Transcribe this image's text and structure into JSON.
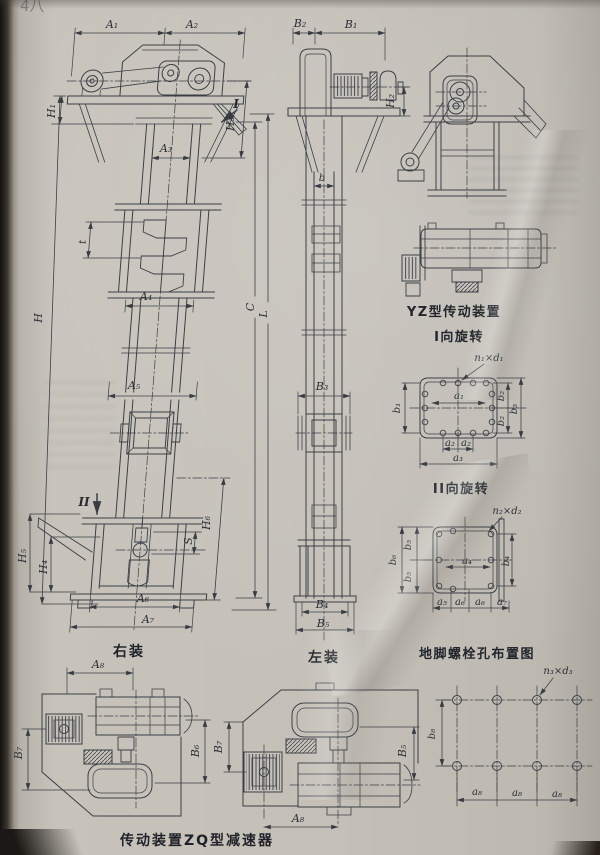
{
  "page": {
    "corner_mark": "4八"
  },
  "front_view": {
    "caption": "右装",
    "dims": {
      "A1": "A₁",
      "A2": "A₂",
      "A3": "A₃",
      "A4": "A₄",
      "A5": "A₅",
      "A6": "A₆",
      "A7": "A₇",
      "H": "H",
      "H1": "H₁",
      "H3": "H₃",
      "H4": "H₄",
      "H5": "H₅",
      "H6": "H₆",
      "S": "S",
      "t": "t"
    },
    "markers": {
      "I": "I",
      "II": "II"
    }
  },
  "side_view": {
    "caption": "左装",
    "dims": {
      "B1": "B₁",
      "B2": "B₂",
      "B3": "B₃",
      "B4": "B₄",
      "B5": "B₅",
      "H2": "H₂",
      "b": "b",
      "C": "C",
      "L": "L"
    }
  },
  "yz_drive_view": {
    "caption": "YZ型传动装置"
  },
  "rotation_view_1": {
    "caption": "I向旋转",
    "labels": {
      "n1d1": "n₁×d₁",
      "a1": "a₁",
      "a2": "a₂",
      "a3": "a₃",
      "b1": "b₁",
      "b2": "b₂",
      "b3": "b₃"
    }
  },
  "rotation_view_2": {
    "caption": "II向旋转",
    "labels": {
      "n2d2": "n₂×d₂",
      "a4": "a₄",
      "a5": "a₅",
      "a6": "a₆",
      "a7": "a₇",
      "b4": "b₄",
      "b5": "b₅",
      "b6": "b₆"
    }
  },
  "anchor_bolt_view": {
    "caption": "地脚螺栓孔布置图",
    "labels": {
      "n3d3": "n₃×d₃",
      "a8": "a₈",
      "b8": "b₈"
    }
  },
  "zq_drive_view": {
    "caption": "传动装置ZQ型减速器",
    "labels": {
      "A8": "A₈",
      "B5": "B₅",
      "B6": "B₆",
      "B7": "B₇"
    }
  }
}
